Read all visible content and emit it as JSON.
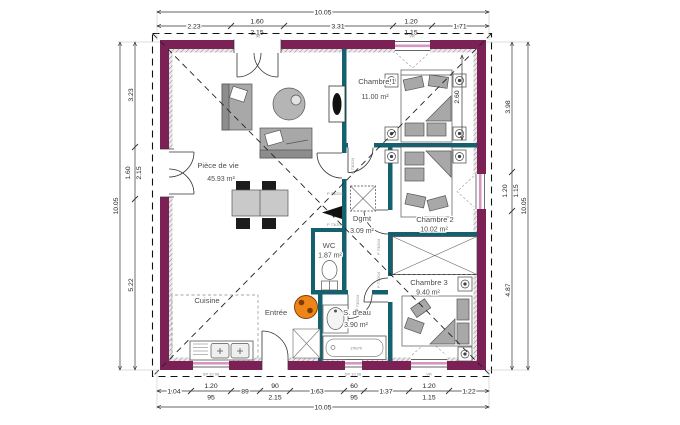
{
  "rooms": {
    "piece_de_vie": {
      "name": "Pièce de vie",
      "area": "45.93 m²"
    },
    "chambre1": {
      "name": "Chambre 1",
      "area": "11.00 m²"
    },
    "chambre2": {
      "name": "Chambre 2",
      "area": "10.02 m²"
    },
    "chambre3": {
      "name": "Chambre 3",
      "area": "9.40 m²"
    },
    "dgmt": {
      "name": "Dgmt",
      "area": "3.09 m²"
    },
    "wc": {
      "name": "WC",
      "area": "1.87 m²"
    },
    "sdeau": {
      "name": "S. d'eau",
      "area": "3.90 m²"
    },
    "cuisine": {
      "name": "Cuisine"
    },
    "entree": {
      "name": "Entrée"
    }
  },
  "dims": {
    "overall": "10.05",
    "top": {
      "seg1": "2.23",
      "seg2a": "1.60",
      "seg2b": "2.15",
      "seg3": "3.31",
      "seg4a": "1.20",
      "seg4b": "1.15",
      "seg5": "1.71"
    },
    "left": {
      "seg1": "3.23",
      "seg2a": "1.60",
      "seg2b": "2.15",
      "seg3": "5.22"
    },
    "right": {
      "seg1": "3.98",
      "seg2a": "1.20",
      "seg2b": "1.15",
      "seg3": "4.87"
    },
    "bottom": {
      "seg1": "1.04",
      "seg2a": "1.20",
      "seg2b": "95",
      "seg3": "89",
      "seg4a": "90",
      "seg4b": "2.15",
      "seg5": "1.63",
      "seg6a": "60",
      "seg6b": "95",
      "seg7": "1.37",
      "seg8a": "1.20",
      "seg8b": "1.15",
      "seg9": "1.22"
    },
    "chambre1_depth": "2.60"
  },
  "annotations": {
    "door_ref": "P 73/204",
    "window_ref": "SP 10 08",
    "shutter": "VR",
    "door_width": "90",
    "bath_size": "170x70"
  },
  "colors": {
    "wall": "#7b2156",
    "partition": "#14606c",
    "heater": "#ef8418",
    "window_glass": "#d795c2"
  }
}
